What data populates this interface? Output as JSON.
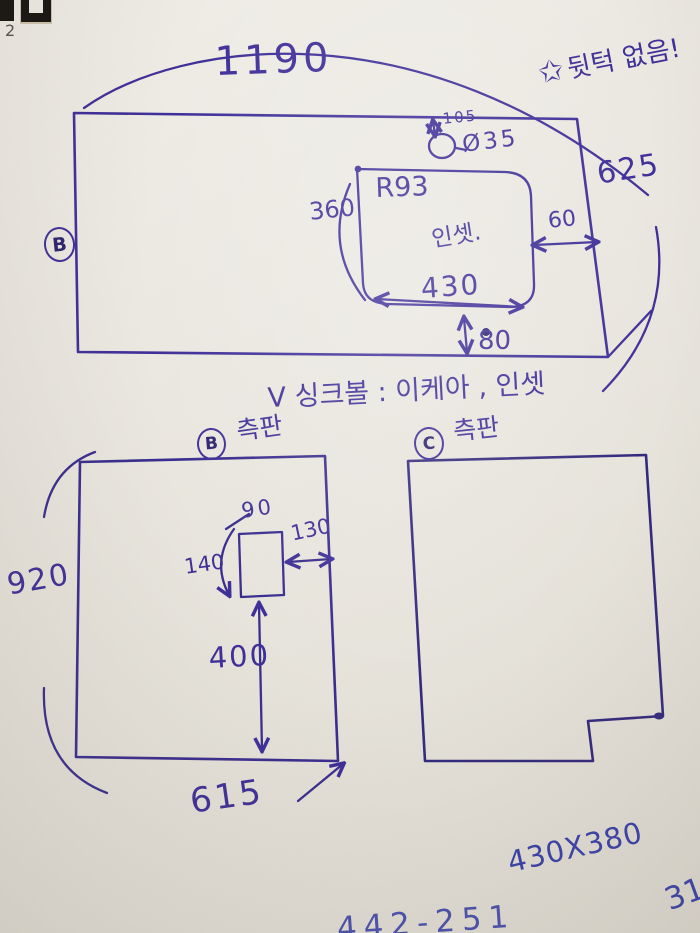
{
  "colors": {
    "ink": "#3f2f98",
    "ink_blue": "#3a41a8",
    "paper": "#eae7e0"
  },
  "page_marks": {
    "corner_number": "2"
  },
  "top_figure": {
    "panel_letter": "B",
    "width": "1190",
    "note_star": "✩",
    "note_text": "뒷턱 없음!",
    "height_right": "625",
    "hole_offset": "105",
    "hole_diameter": "Ø35",
    "corner_radius": "R93",
    "cutout_height": "360",
    "cutout_label": "인셋.",
    "cutout_width": "430",
    "gap_right": "60",
    "gap_bottom": "80"
  },
  "middle_note": "V 싱크볼 : 이케아 , 인셋",
  "bottom_left_figure": {
    "panel_letter": "B",
    "panel_name": "측판",
    "height": "920",
    "width": "615",
    "slot_width": "90",
    "slot_gap_right": "130",
    "slot_height": "140",
    "slot_offset_bottom": "400"
  },
  "bottom_right_figure": {
    "panel_letter": "C",
    "panel_name": "측판"
  },
  "bottom_notes": {
    "size": "430X380",
    "page": "31",
    "clipped_fragment": "442-251"
  }
}
